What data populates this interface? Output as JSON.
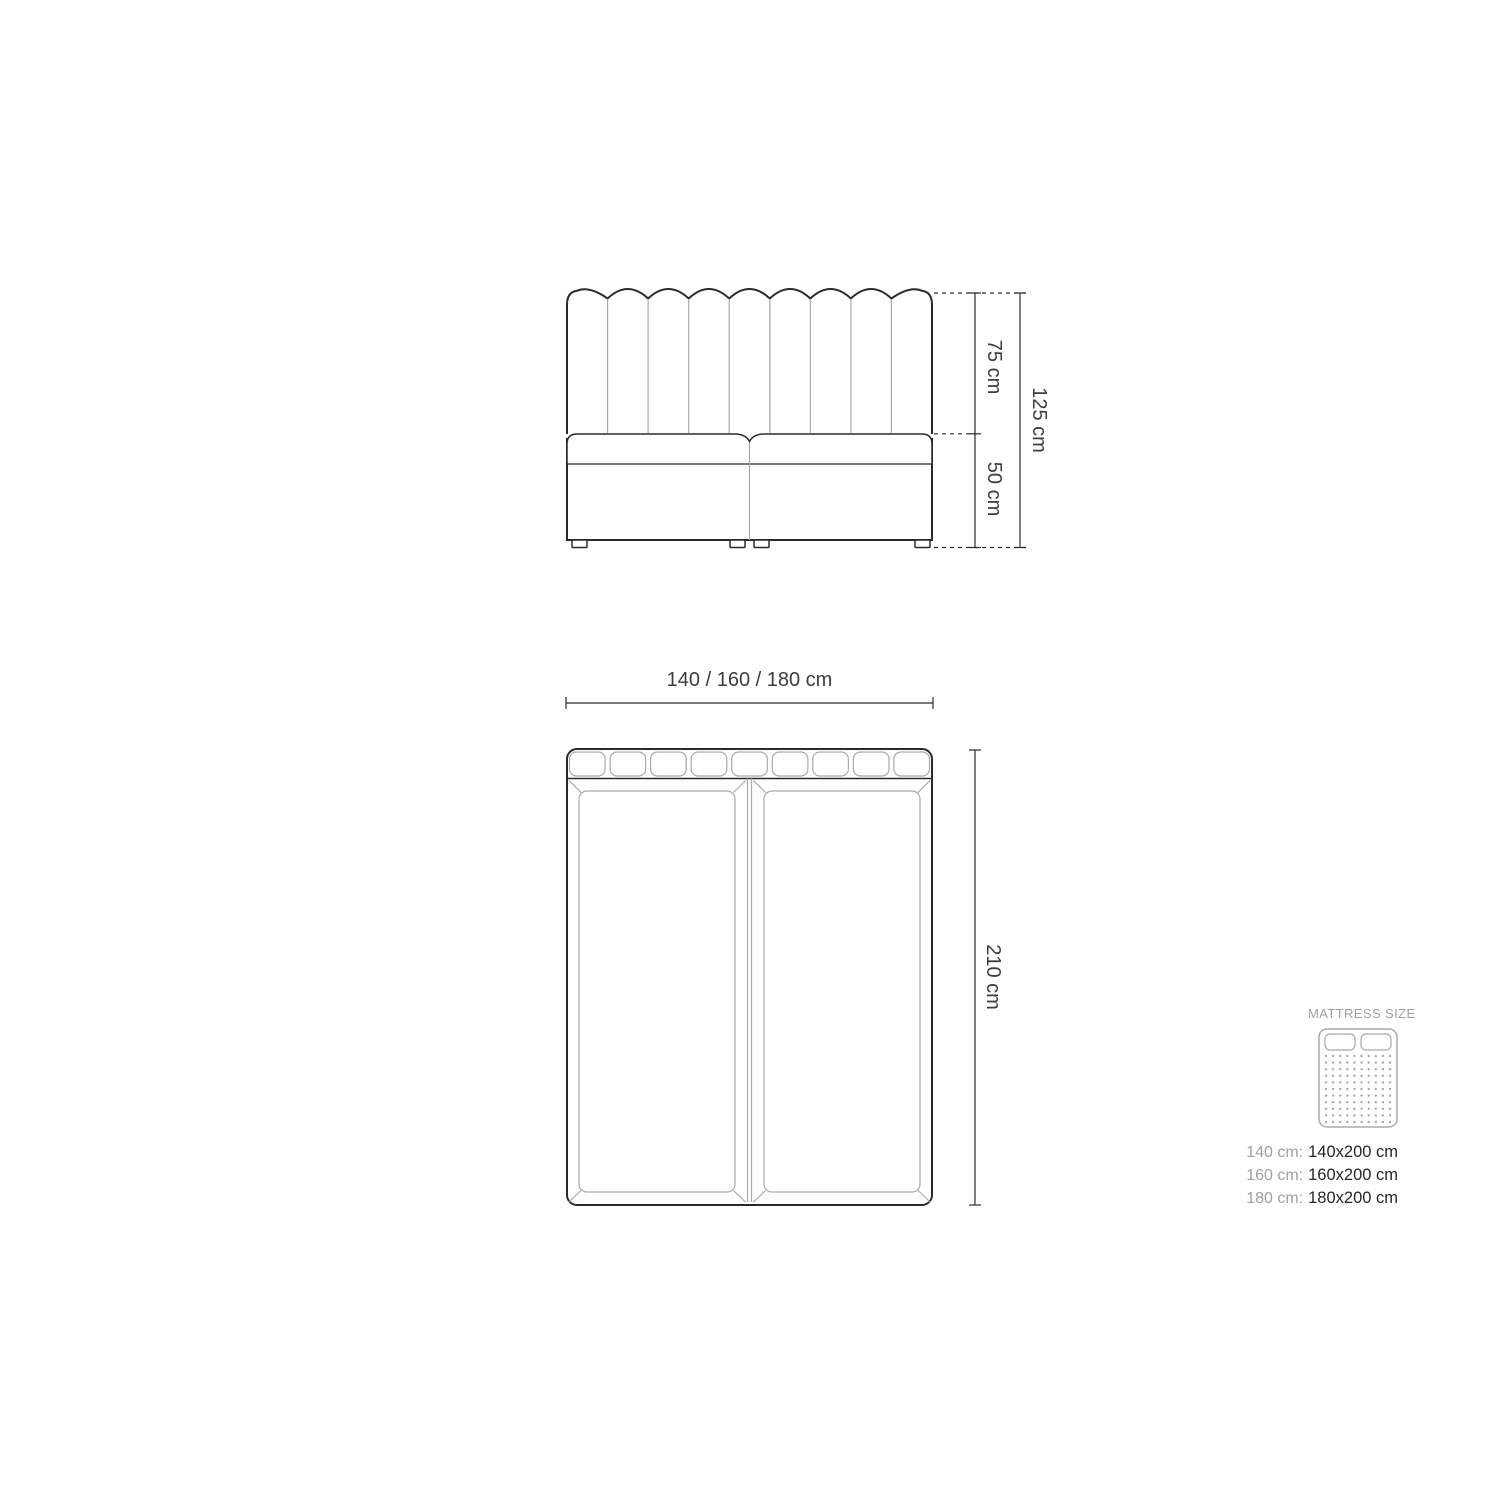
{
  "drawing": {
    "front_view": {
      "headboard_height_label": "75 cm",
      "base_height_label": "50 cm",
      "total_height_label": "125 cm"
    },
    "top_view": {
      "width_label": "140 / 160 / 180 cm",
      "depth_label": "210 cm"
    }
  },
  "legend": {
    "title": "MATTRESS SIZE",
    "sizes": [
      {
        "label": "140 cm:",
        "value": "140x200 cm"
      },
      {
        "label": "160 cm:",
        "value": "160x200 cm"
      },
      {
        "label": "180 cm:",
        "value": "180x200 cm"
      }
    ]
  },
  "colors": {
    "bg": "#ffffff",
    "lineDark": "#2b2b2b",
    "lineGray": "#a9a9a9",
    "textDark": "#3d3d3d",
    "textMuted": "#a0a0a0",
    "textStrong": "#262626"
  }
}
